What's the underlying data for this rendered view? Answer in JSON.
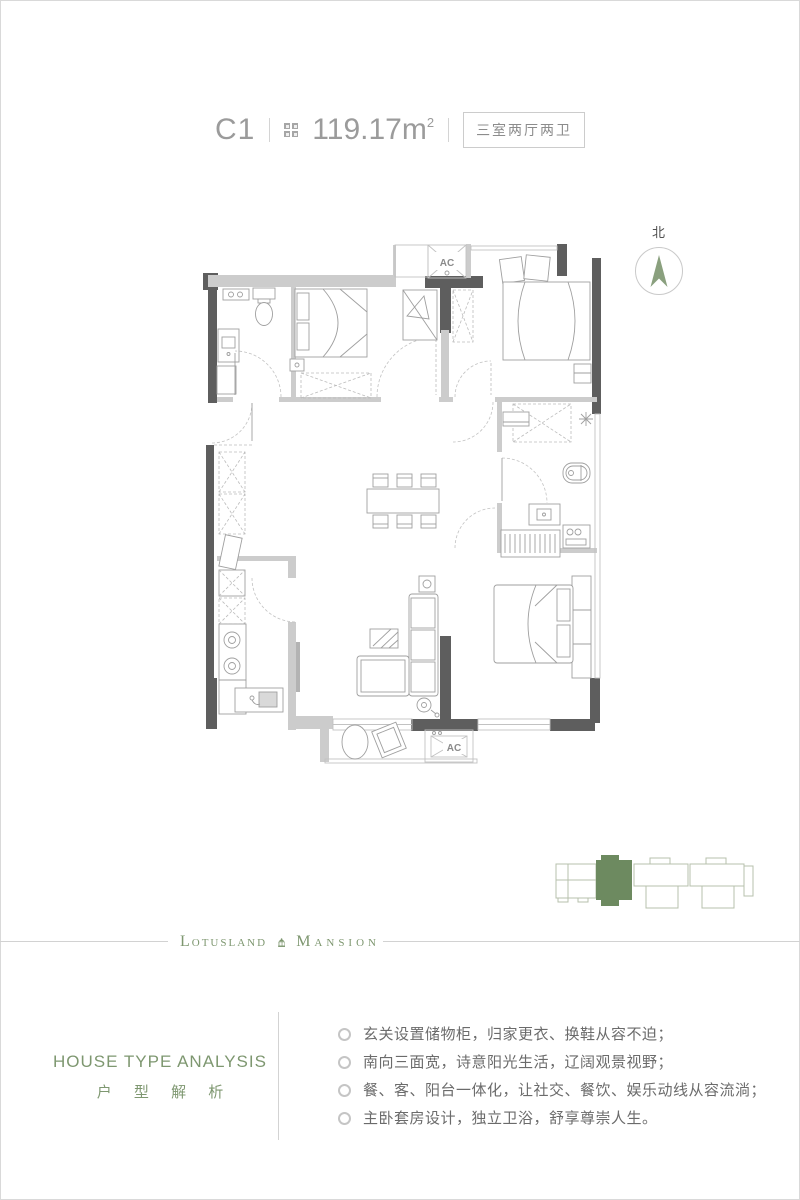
{
  "header": {
    "unit_label": "C1",
    "area_value": "119.17m",
    "area_sup": "2",
    "layout_label": "三室两厅两卫"
  },
  "compass": {
    "label": "北",
    "arrow_color": "#8aa07e"
  },
  "floor_plan": {
    "ac_label_top": "AC",
    "ac_label_bottom": "AC",
    "wall_color": "#5e5e5e",
    "light_wall_color": "#cccccc",
    "furniture_line_color": "#9f9f9f"
  },
  "site_diagram": {
    "highlight_color": "#6d8a60",
    "outline_color": "#b7c0ac"
  },
  "logo": {
    "left_word": "Lotusland",
    "right_word": "Mansion",
    "color": "#7e9770"
  },
  "analysis": {
    "title_en": "HOUSE TYPE ANALYSIS",
    "title_cn": "户 型 解 析",
    "bullets": [
      "玄关设置储物柜，归家更衣、换鞋从容不迫；",
      "南向三面宽，诗意阳光生活，辽阔观景视野；",
      "餐、客、阳台一体化，让社交、餐饮、娱乐动线从容流淌；",
      "主卧套房设计，独立卫浴，舒享尊崇人生。"
    ]
  }
}
